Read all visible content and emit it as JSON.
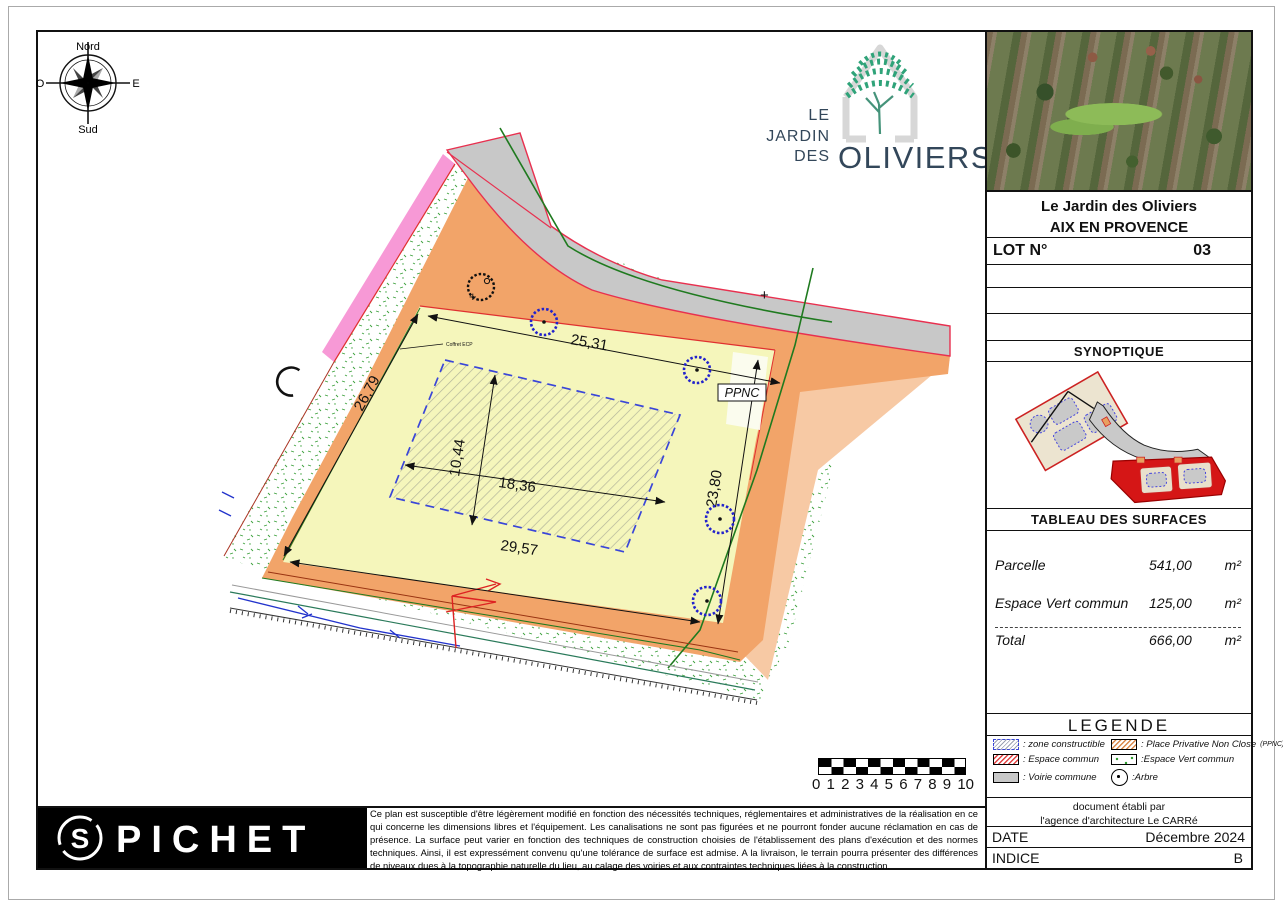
{
  "compass": {
    "north": "Nord",
    "south": "Sud",
    "west": "O",
    "east": "E"
  },
  "logo": {
    "le": "LE",
    "jardin": "JARDIN",
    "des": "DES",
    "oliviers": "OLIVIERS"
  },
  "plan": {
    "dimensions": {
      "top": "25,31",
      "left": "26,79",
      "bottom": "29,57",
      "right": "23,80",
      "zone_width": "18,36",
      "zone_height": "10,44"
    },
    "ppnc_label": "PPNC",
    "coffret_label": "Coffret ECP",
    "plus_marker": "+"
  },
  "scalebar": {
    "ticks": [
      "0",
      "1",
      "2",
      "3",
      "4",
      "5",
      "6",
      "7",
      "8",
      "9",
      "10"
    ]
  },
  "title_block": {
    "project": "Le Jardin des Oliviers",
    "city": "AIX EN PROVENCE",
    "lot_label": "LOT N°",
    "lot_number": "03",
    "synoptique_title": "SYNOPTIQUE",
    "surfaces_title": "TABLEAU DES SURFACES",
    "surfaces": [
      {
        "label": "Parcelle",
        "value": "541,00",
        "unit": "m²"
      },
      {
        "label": "Espace Vert commun",
        "value": "125,00",
        "unit": "m²"
      }
    ],
    "total": {
      "label": "Total",
      "value": "666,00",
      "unit": "m²"
    },
    "legend_title": "LEGENDE",
    "legend": [
      {
        "label": ": zone constructible"
      },
      {
        "label": ": Place Privative Non Close",
        "suffix": "(PPNC)"
      },
      {
        "label": ": Espace commun"
      },
      {
        "label": ":Espace Vert commun"
      },
      {
        "label": ": Voirie commune"
      },
      {
        "label": ":Arbre"
      }
    ],
    "credit_line1": "document établi par",
    "credit_line2": "l'agence d'architecture Le CARRé",
    "date_label": "DATE",
    "date_value": "Décembre 2024",
    "indice_label": "INDICE",
    "indice_value": "B"
  },
  "footer": {
    "brand": "PICHET",
    "disclaimer": "Ce plan est susceptible d'être légèrement modifié en fonction des nécessités techniques, réglementaires et administratives de la réalisation en ce qui concerne les dimensions libres et l'équipement. Les canalisations ne sont pas figurées et ne pourront fonder aucune réclamation en cas de présence. La surface  peut varier en fonction des techniques de construction choisies de l'établissement des plans d'exécution et des normes techniques. Ainsi, il est expressément convenu qu'une tolérance de surface est admise.  A la livraison, le terrain pourra présenter des différences de niveaux dues à la topographie naturelle du lieu, au calage des voiries et aux contraintes techniques liées à la construction."
  },
  "colors": {
    "parcel_yellow": "#f5f6bb",
    "band_orange": "#f2a469",
    "road_gray": "#c8c8c8",
    "boundary_pink": "#f799d6",
    "boundary_red": "#e03040",
    "tree_blue": "#2222cc",
    "green_line": "#1f7a1f",
    "zone_dash_blue": "#3a46d8",
    "lot_red": "#d51616"
  }
}
